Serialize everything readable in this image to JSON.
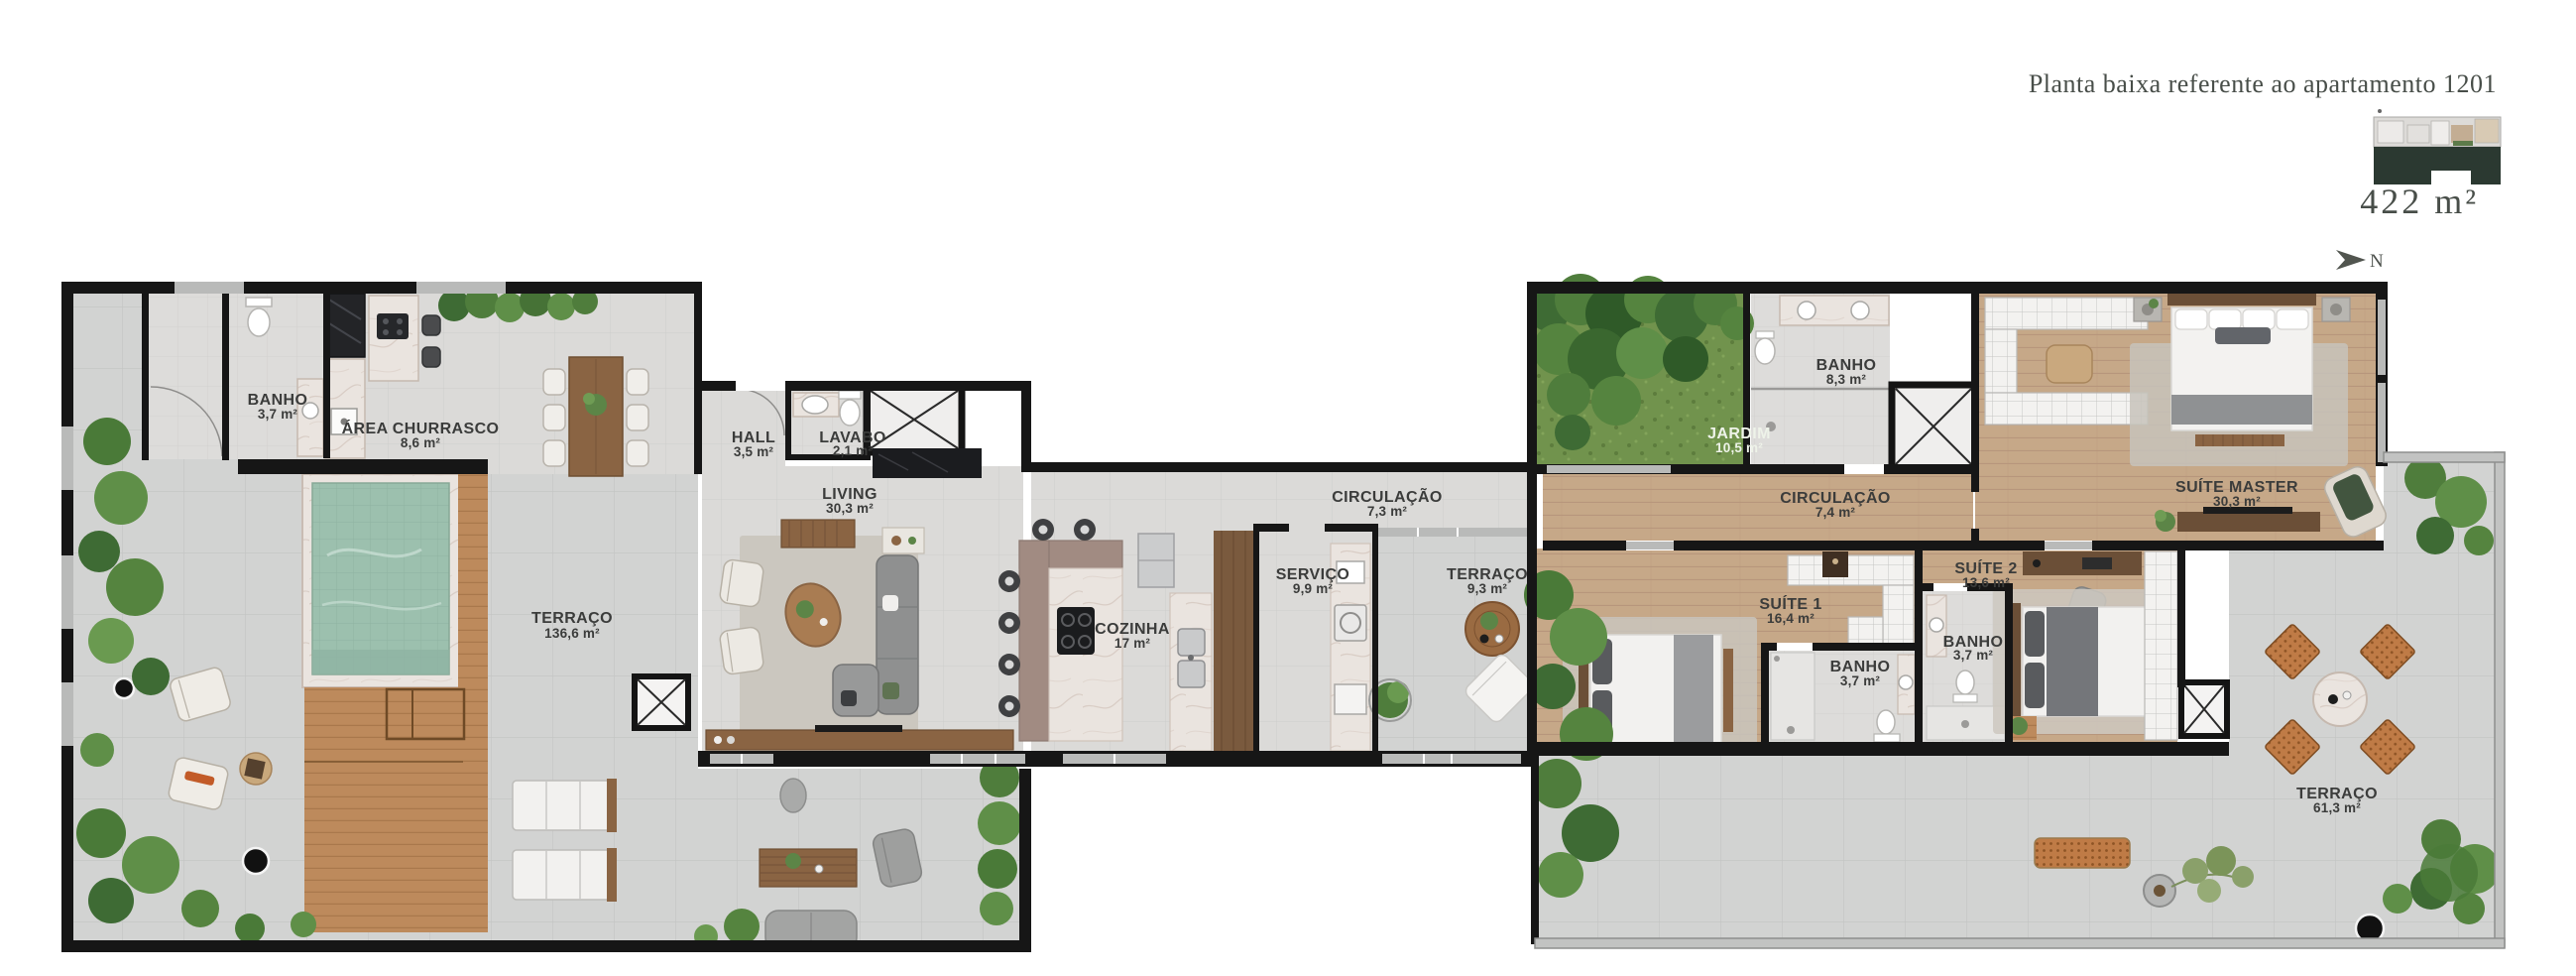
{
  "header": {
    "title": "Planta baixa referente ao apartamento 1201",
    "total_area": "422 m²",
    "north_label": "N"
  },
  "rooms": [
    {
      "id": "banho-entrada",
      "name": "BANHO",
      "area": "3,7 m²"
    },
    {
      "id": "area-churrasco",
      "name": "ÁREA CHURRASCO",
      "area": "8,6 m²"
    },
    {
      "id": "hall",
      "name": "HALL",
      "area": "3,5 m²"
    },
    {
      "id": "lavabo",
      "name": "LAVABO",
      "area": "2,1 m²"
    },
    {
      "id": "living",
      "name": "LIVING",
      "area": "30,3 m²"
    },
    {
      "id": "terraco-principal",
      "name": "TERRAÇO",
      "area": "136,6 m²"
    },
    {
      "id": "cozinha",
      "name": "COZINHA",
      "area": "17 m²"
    },
    {
      "id": "circulacao-1",
      "name": "CIRCULAÇÃO",
      "area": "7,3 m²"
    },
    {
      "id": "servico",
      "name": "SERVIÇO",
      "area": "9,9 m²"
    },
    {
      "id": "terraco-servico",
      "name": "TERRAÇO",
      "area": "9,3 m²"
    },
    {
      "id": "jardim",
      "name": "JARDIM",
      "area": "10,5 m²"
    },
    {
      "id": "banho-social",
      "name": "BANHO",
      "area": "8,3 m²"
    },
    {
      "id": "circulacao-2",
      "name": "CIRCULAÇÃO",
      "area": "7,4 m²"
    },
    {
      "id": "suite-master",
      "name": "SUÍTE MASTER",
      "area": "30,3 m²"
    },
    {
      "id": "suite-1",
      "name": "SUÍTE 1",
      "area": "16,4 m²"
    },
    {
      "id": "suite-2",
      "name": "SUÍTE 2",
      "area": "13,6 m²"
    },
    {
      "id": "banho-suite-1",
      "name": "BANHO",
      "area": "3,7 m²"
    },
    {
      "id": "banho-suite-2",
      "name": "BANHO",
      "area": "3,7 m²"
    },
    {
      "id": "terraco-suites",
      "name": "TERRAÇO",
      "area": "61,3 m²"
    }
  ],
  "colors": {
    "walls": "#161616",
    "terrace_tile": "#d2d3d2",
    "interior_tile": "#dbdad8",
    "wood_floor": "#c6a888",
    "deck": "#bd8a5c",
    "pool_water": "#9cc0ae",
    "grass": "#71934d",
    "marble": "#eae4df",
    "keyplan_mass": "#2b3931",
    "label": "#3b3c3b",
    "title": "#484e49"
  }
}
